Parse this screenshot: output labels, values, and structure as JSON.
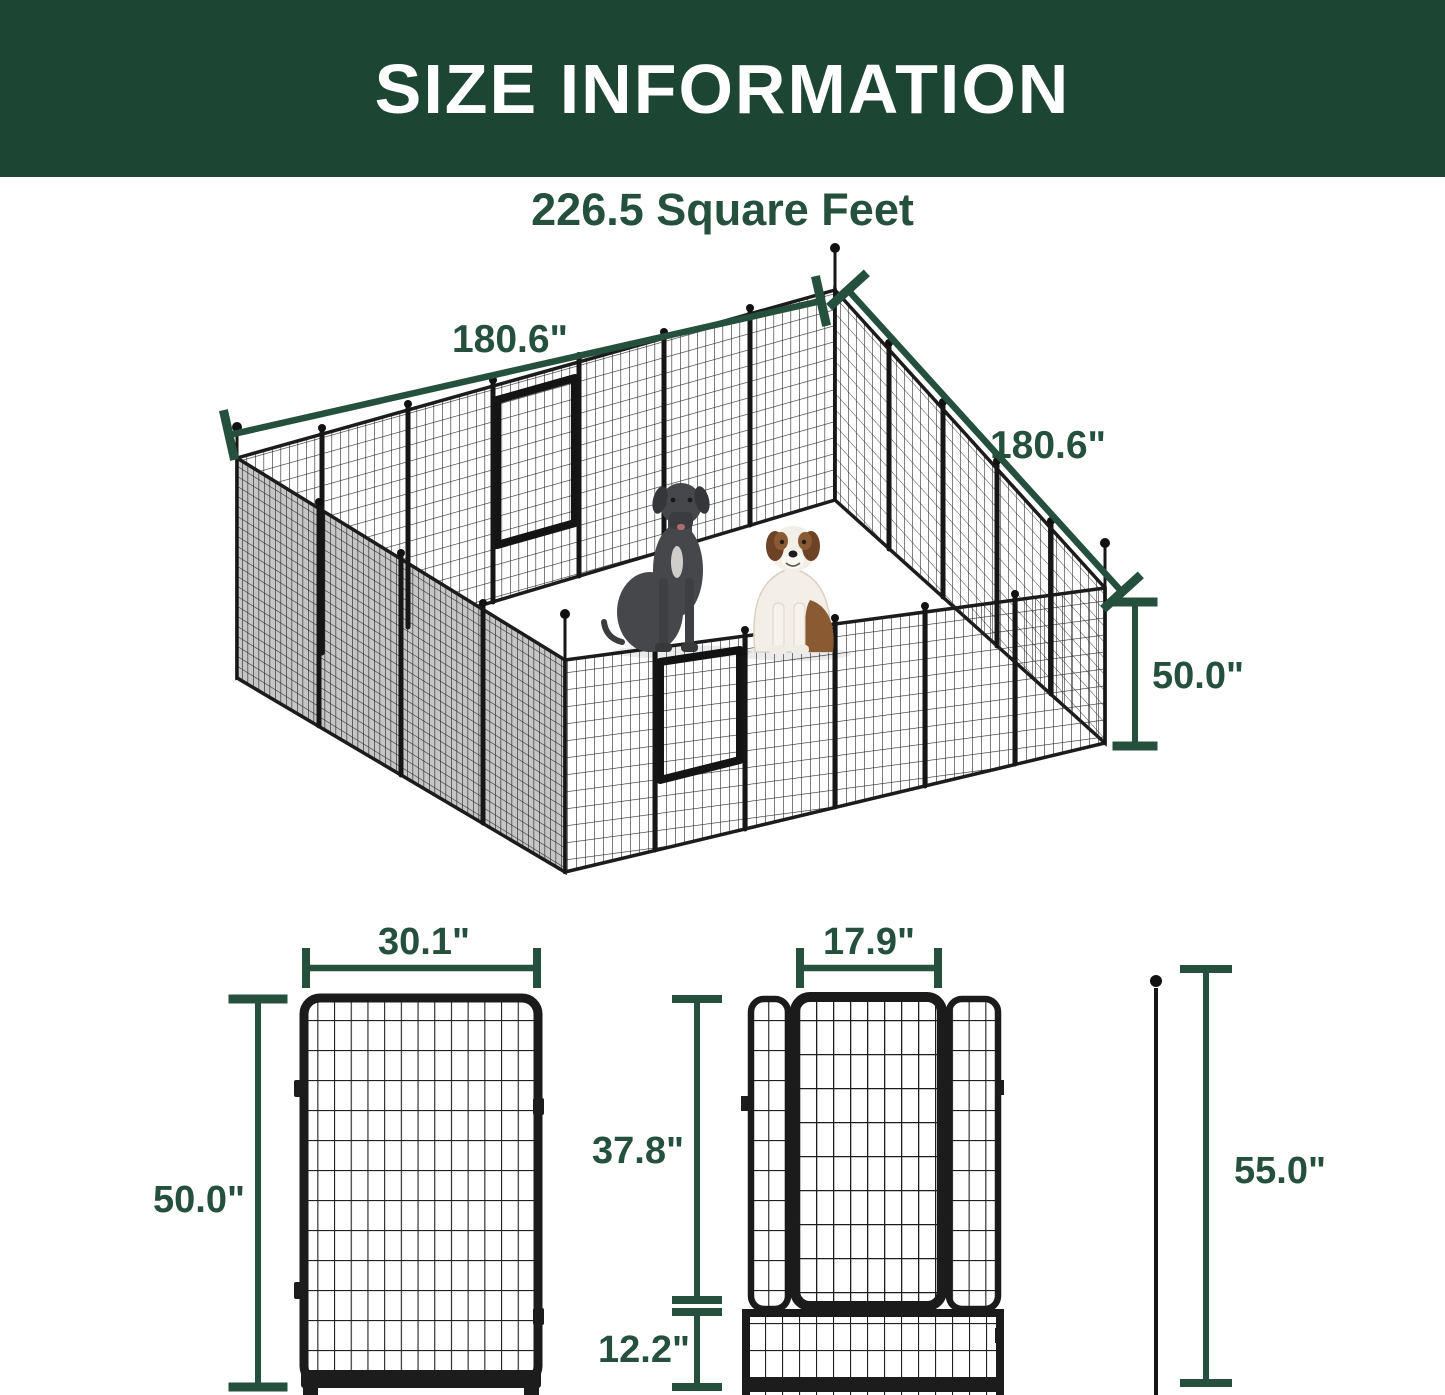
{
  "header": {
    "title": "SIZE INFORMATION"
  },
  "subtitle": "226.5 Square Feet",
  "colors": {
    "banner_green": "#1d4534",
    "dimension_green": "#25503e",
    "frame_black": "#1c1c1c"
  },
  "isometric": {
    "width_label": "180.6\"",
    "depth_label": "180.6\"",
    "height_label": "50.0\""
  },
  "panel_diagram": {
    "width_label": "30.1\"",
    "height_label": "50.0\""
  },
  "gate_diagram": {
    "width_label": "17.9\"",
    "upper_height_label": "37.8\"",
    "lower_height_label": "12.2\""
  },
  "stake_diagram": {
    "height_label": "55.0\""
  }
}
